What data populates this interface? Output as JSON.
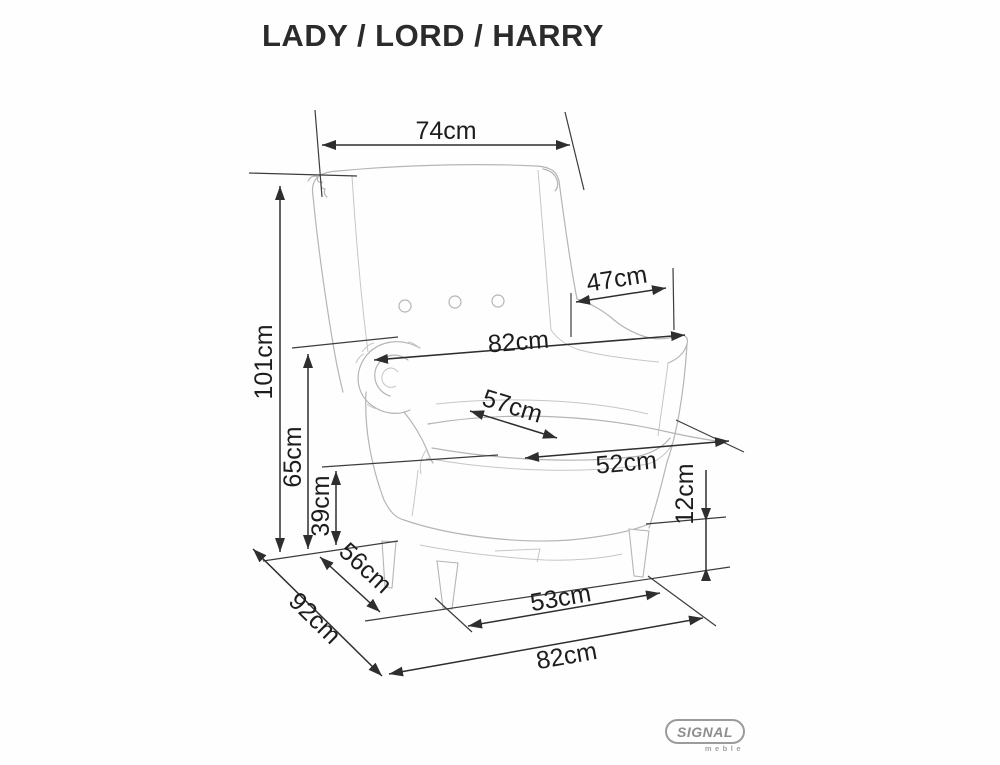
{
  "title": "LADY / LORD / HARRY",
  "dimensions": [
    {
      "id": "width_top",
      "label": "74cm"
    },
    {
      "id": "height_total",
      "label": "101cm"
    },
    {
      "id": "height_armrest",
      "label": "65cm"
    },
    {
      "id": "height_seat",
      "label": "39cm"
    },
    {
      "id": "width_between_arms",
      "label": "47cm"
    },
    {
      "id": "width_overall",
      "label": "82cm"
    },
    {
      "id": "depth_seat",
      "label": "57cm"
    },
    {
      "id": "width_seat_front",
      "label": "52cm"
    },
    {
      "id": "height_legs",
      "label": "12cm"
    },
    {
      "id": "depth_base",
      "label": "56cm"
    },
    {
      "id": "depth_overall",
      "label": "92cm"
    },
    {
      "id": "width_leg_span",
      "label": "53cm"
    },
    {
      "id": "width_base",
      "label": "82cm"
    }
  ],
  "logo": {
    "brand": "SIGNAL",
    "subtitle": "meble"
  },
  "colors": {
    "dimension_lines": "#2e2e2e",
    "chair_outline": "#b5b5b5",
    "logo_gray": "#9b9b9b"
  }
}
